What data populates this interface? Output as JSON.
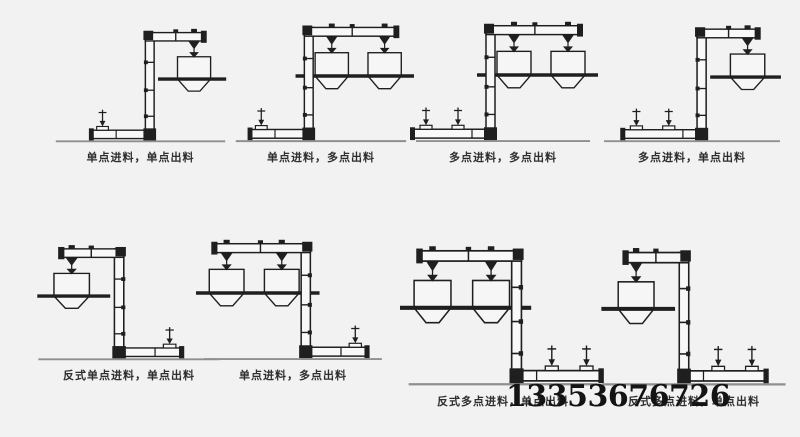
{
  "page": {
    "background": "#f2f2f2"
  },
  "phone_number": "13353676726",
  "colors": {
    "ink": "#1f1f1f",
    "pipe_fill": "#f8f8f8",
    "ground": "#8f8f8f",
    "hopper_fill": "#f6f6f6"
  },
  "diagrams": [
    {
      "caption": "单点进料，单点出料",
      "feeds": 1,
      "hoppers": 1,
      "reversed": false
    },
    {
      "caption": "单点进料，多点出料",
      "feeds": 1,
      "hoppers": 2,
      "reversed": false
    },
    {
      "caption": "多点进料，多点出料",
      "feeds": 2,
      "hoppers": 2,
      "reversed": false
    },
    {
      "caption": "多点进料，单点出料",
      "feeds": 2,
      "hoppers": 1,
      "reversed": false
    },
    {
      "caption": "反式单点进料，单点出料",
      "feeds": 1,
      "hoppers": 1,
      "reversed": true
    },
    {
      "caption": "单点进料，多点出料",
      "feeds": 1,
      "hoppers": 2,
      "reversed": true
    },
    {
      "caption": "反式多点进料，单点出料",
      "feeds": 2,
      "hoppers": 2,
      "reversed": true
    },
    {
      "caption": "反式多点进料，单点出料",
      "feeds": 2,
      "hoppers": 1,
      "reversed": true
    }
  ]
}
